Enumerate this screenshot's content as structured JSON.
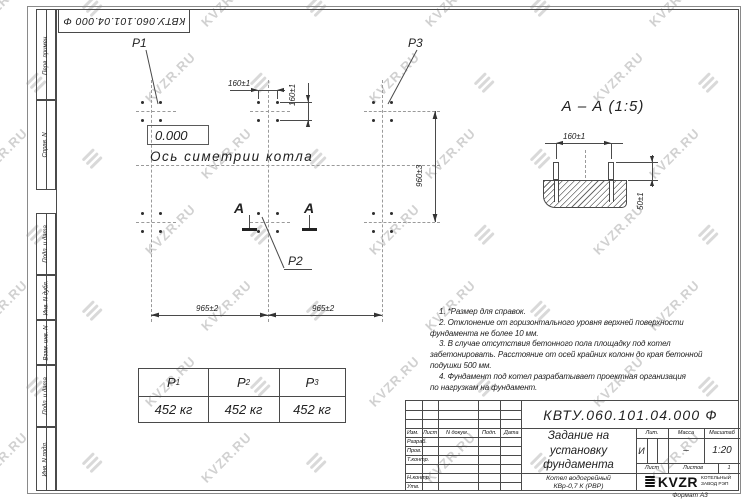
{
  "watermark": {
    "text": "KVZR.RU"
  },
  "stamp_top": {
    "doc_number": "КВТУ.060.101.04.000  Ф"
  },
  "margin_labels": [
    "Перв. примен.",
    "Справ. N",
    "Подп. и дата",
    "Инв. N дубл.",
    "Взам. инв. N",
    "Подп. и дата",
    "Инв. N подл."
  ],
  "plan": {
    "elevation": "0.000",
    "axis_label": "Ось симетрии котла",
    "points": {
      "p1": "P1",
      "p2": "P2",
      "p3": "P3"
    },
    "section_letter_left": "А",
    "section_letter_right": "А",
    "dims": {
      "d160h": "160±1",
      "d160v": "160±1",
      "d960": "960±3",
      "d965l": "965±2",
      "d965r": "965±2"
    }
  },
  "section": {
    "title": "А – А (1:5)",
    "dims": {
      "d160": "160±1",
      "d50": "50±1"
    }
  },
  "notes": {
    "lines": [
      "1. *Размер для справок.",
      "2. Отклонение от горизонтального уровня верхней поверхности",
      "фундамента не более 10 мм.",
      "3. В случае отсутствия бетонного пола площадку под котел",
      "забетонировать. Расстояние от осей крайних колонн до края бетонной",
      "подушки 500 мм.",
      "4. Фундамент под котел разрабатывает проектная организация",
      "по нагрузкам на фундамент."
    ]
  },
  "load_table": {
    "headers": [
      {
        "base": "P",
        "sub": "1"
      },
      {
        "base": "P",
        "sub": "2"
      },
      {
        "base": "P",
        "sub": "3"
      }
    ],
    "values": [
      "452 кг",
      "452 кг",
      "452 кг"
    ]
  },
  "title_block": {
    "doc_number": "КВТУ.060.101.04.000  Ф",
    "title_lines": [
      "Задание на",
      "установку",
      "фундамента"
    ],
    "product_lines": [
      "Котел водогрейный",
      "КВр-0,7 К (РВР)"
    ],
    "columns": {
      "izm": "Изм.",
      "list": "Лист",
      "ndoc": "N докум.",
      "podp": "Подп.",
      "data": "Дата"
    },
    "rows": [
      "Разраб.",
      "Пров.",
      "Т.контр.",
      "",
      "Н.контр.",
      "Утв."
    ],
    "lit_header": "Лит.",
    "mass_header": "Масса",
    "scale_header": "Масштаб",
    "lit_value": "И",
    "mass_value": "–",
    "scale_value": "1:20",
    "sheet_header": "Лист",
    "sheets_header": "Листов",
    "sheets_value": "1",
    "logo": {
      "text": "KVZR",
      "sub1": "КОТЕЛЬНЫЙ",
      "sub2": "ЗАВОД РЭП"
    },
    "format": "Формат А3"
  }
}
